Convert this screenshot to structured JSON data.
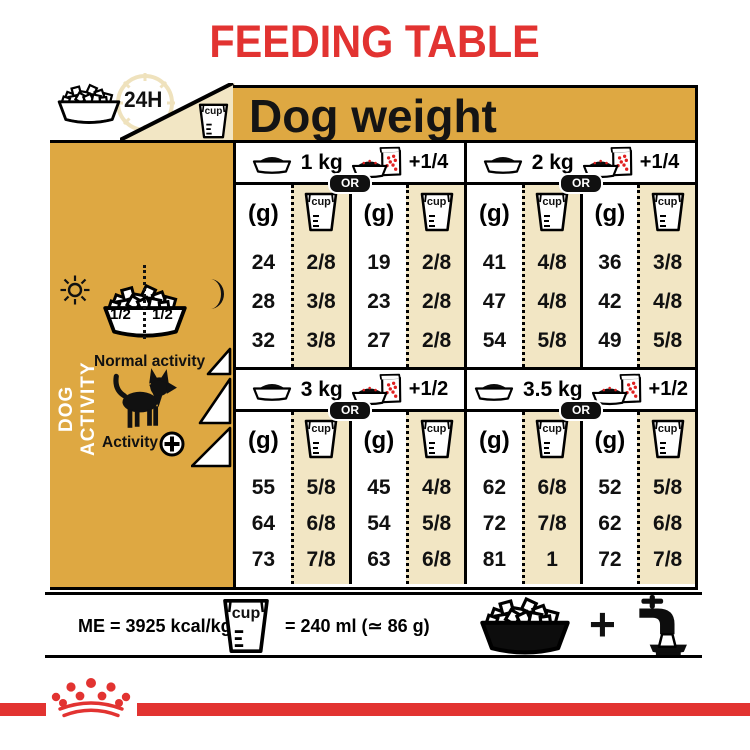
{
  "title": "FEEDING TABLE",
  "header": {
    "dog_weight_label": "Dog weight",
    "hours_label": "24H"
  },
  "labels": {
    "cup": "cup"
  },
  "sidebar": {
    "vertical_label": "DOG ACTIVITY",
    "half_left": "1/2",
    "half_right": "1/2",
    "normal_activity_label": "Normal activity",
    "activity_label": "Activity"
  },
  "table": {
    "or_label": "OR",
    "gram_header": "(g)",
    "sections": [
      {
        "weight": "1 kg",
        "wet_add": "+1/4",
        "dry_only": {
          "grams": [
            "24",
            "28",
            "32"
          ],
          "cups": [
            "2/8",
            "3/8",
            "3/8"
          ]
        },
        "dry_wet": {
          "grams": [
            "19",
            "23",
            "27"
          ],
          "cups": [
            "2/8",
            "2/8",
            "2/8"
          ]
        }
      },
      {
        "weight": "2 kg",
        "wet_add": "+1/4",
        "dry_only": {
          "grams": [
            "41",
            "47",
            "54"
          ],
          "cups": [
            "4/8",
            "4/8",
            "5/8"
          ]
        },
        "dry_wet": {
          "grams": [
            "36",
            "42",
            "49"
          ],
          "cups": [
            "3/8",
            "4/8",
            "5/8"
          ]
        }
      },
      {
        "weight": "3 kg",
        "wet_add": "+1/2",
        "dry_only": {
          "grams": [
            "55",
            "64",
            "73"
          ],
          "cups": [
            "5/8",
            "6/8",
            "7/8"
          ]
        },
        "dry_wet": {
          "grams": [
            "45",
            "54",
            "63"
          ],
          "cups": [
            "4/8",
            "5/8",
            "6/8"
          ]
        }
      },
      {
        "weight": "3.5 kg",
        "wet_add": "+1/2",
        "dry_only": {
          "grams": [
            "62",
            "72",
            "81"
          ],
          "cups": [
            "6/8",
            "7/8",
            "1"
          ]
        },
        "dry_wet": {
          "grams": [
            "52",
            "62",
            "72"
          ],
          "cups": [
            "5/8",
            "6/8",
            "7/8"
          ]
        }
      }
    ]
  },
  "footer": {
    "me_label": "ME = 3925 kcal/kg",
    "cup_equals": "= 240 ml (≃ 86 g)",
    "plus_sign": "+"
  },
  "icons": {
    "kibble-bowl": "bowl of dry kibble",
    "measuring-cup": "measuring cup",
    "clock-24h": "24 hour clock ring",
    "dry-bowl": "bowl with dry food",
    "pouch-bowl": "bowl with wet food pouch",
    "sun": "day symbol",
    "moon": "night symbol",
    "dog": "chihuahua silhouette",
    "activity-plus": "plus in circle",
    "activity-triangles": "activity level ramp",
    "water-tap": "tap filling water bowl",
    "crown": "royal canin crown logo"
  },
  "colors": {
    "gold": "#DEA842",
    "cream": "#F2E6C4",
    "red": "#E23331"
  }
}
